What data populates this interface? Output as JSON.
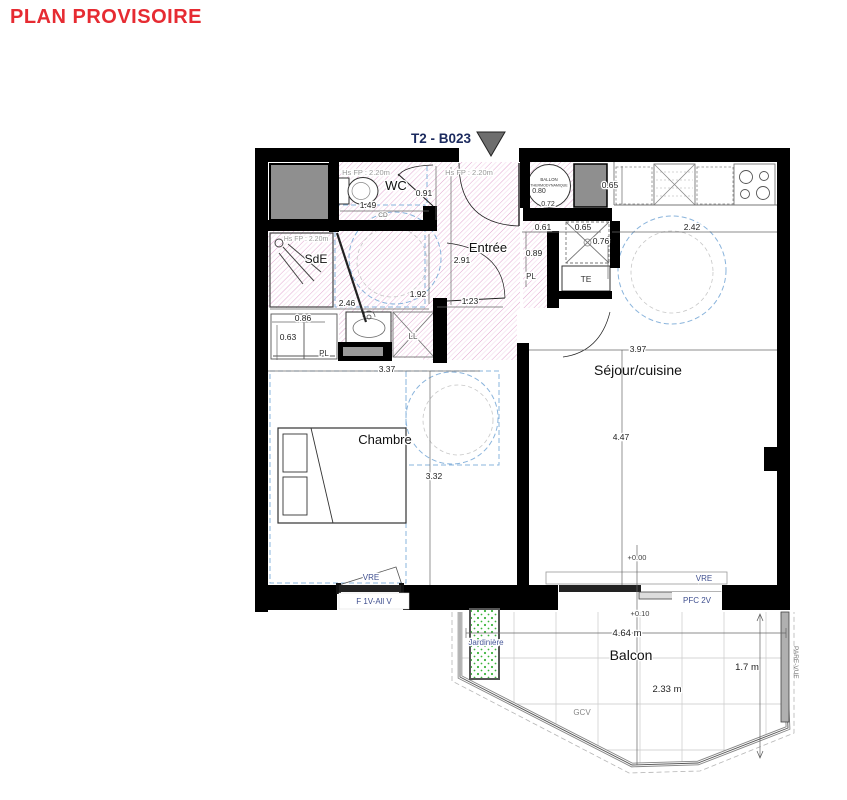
{
  "title": "PLAN PROVISOIRE",
  "unit": "T2 - B023",
  "rooms": {
    "wc": "WC",
    "sde": "SdE",
    "entree": "Entrée",
    "sejour": "Séjour/cuisine",
    "chambre": "Chambre",
    "balcon": "Balcon"
  },
  "notes": {
    "height": "Hs FP : 2.20m",
    "ballon1": "BALLON",
    "ballon2": "THERMODYNAMIQUE",
    "te": "TE",
    "pl": "PL",
    "ll": "LL",
    "cd": "CD",
    "gcv": "GCV",
    "pare_vue": "PARE-VUE",
    "jardiniere": "Jardinière"
  },
  "windows": {
    "vre": "VRE",
    "fenetre_chambre": "F 1V-All V",
    "porte_fenetre_sejour": "PFC 2V"
  },
  "levels": {
    "interieur": "+0.00",
    "balcon": "+0.10"
  },
  "dims": {
    "wc_door": "0.91",
    "wc_width": "1.49",
    "entree_depth": "2.91",
    "degagement": "1.92",
    "porte_chambre": "1.23",
    "sde_width": "2.46",
    "niche_1": "0.61",
    "niche_2": "0.65",
    "frigo_depth": "0.76",
    "placard_depth": "0.89",
    "cuisine_length": "2.42",
    "plan_travail_depth": "0.65",
    "ballon_d1": "0.80",
    "ballon_d2": "0.72",
    "sejour_width": "3.97",
    "sejour_length": "4.47",
    "chambre_width": "3.37",
    "chambre_length": "3.32",
    "placard_chambre_w": "0.86",
    "placard_chambre_d": "0.63",
    "balcon_width": "4.64 m",
    "balcon_depth": "2.33 m",
    "balcon_side": "1.7 m"
  },
  "colors": {
    "title": "#e62b32",
    "unit_label": "#1b2a5e",
    "walls": "#000000",
    "hatch": "#c85aa8",
    "clearance_blue": "#8ab4dc",
    "window_label_blue": "#3f4f8f",
    "shaft_gray": "#8f8f8f",
    "jardiniere_green": "#3db53d"
  }
}
